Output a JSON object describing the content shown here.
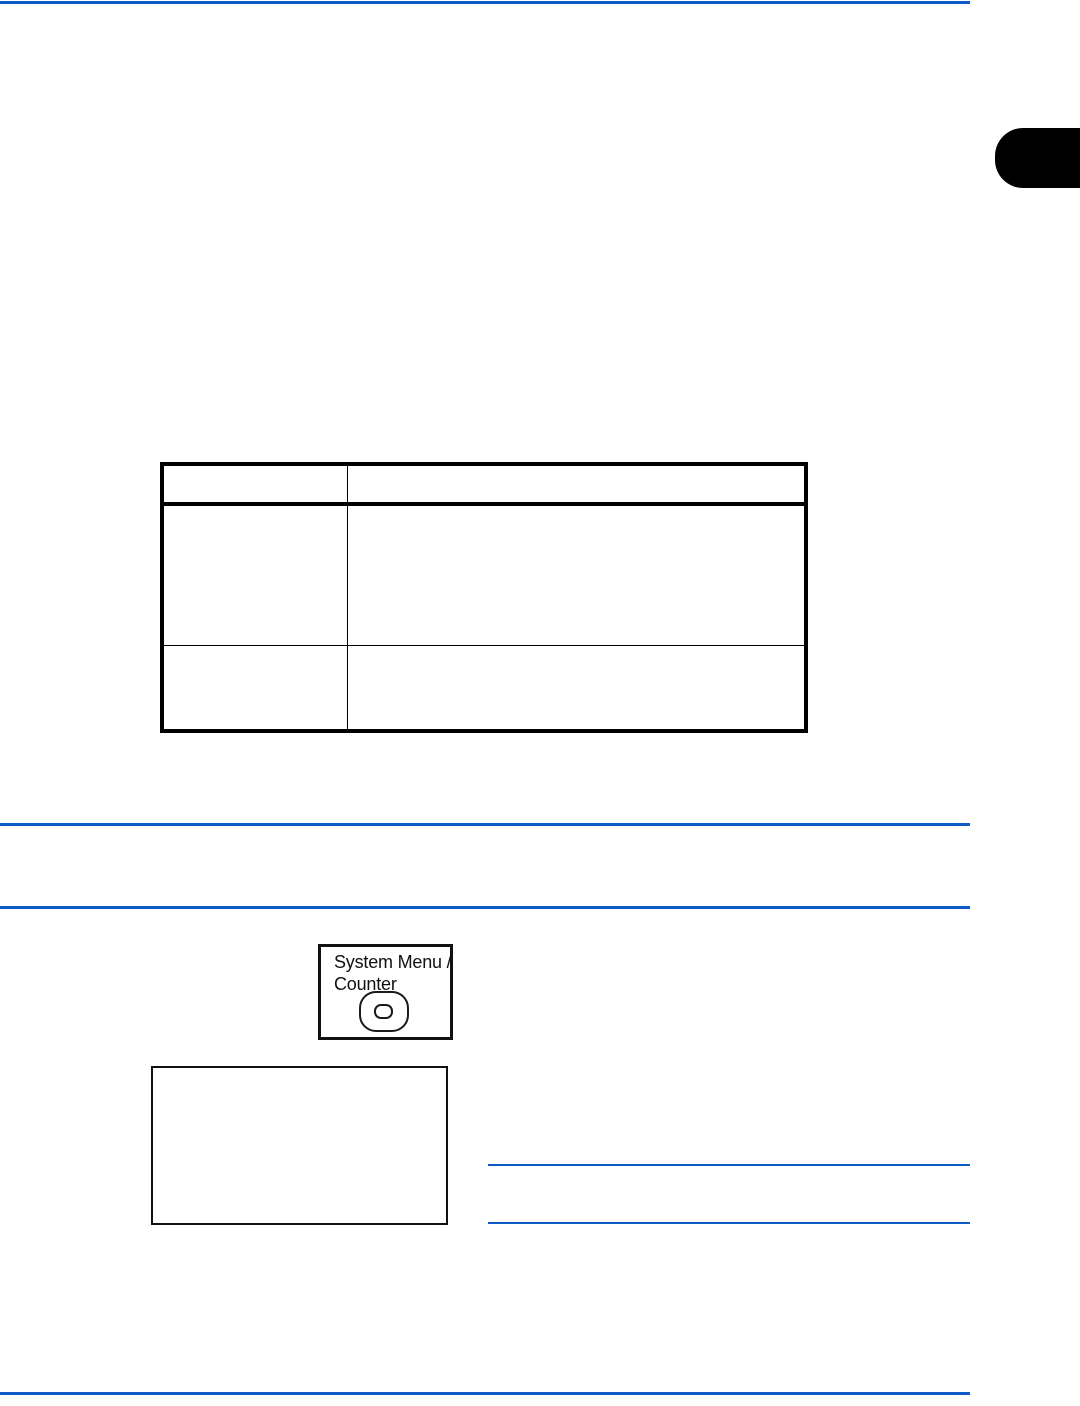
{
  "colors": {
    "rule_blue": "#0d5cc6",
    "ink_black": "#000000",
    "page_background": "#ffffff"
  },
  "edge_tab": {
    "icon": "chapter-index-tab"
  },
  "table": {
    "header_cells": [
      "",
      ""
    ],
    "rows": [
      [
        "",
        ""
      ],
      [
        "",
        ""
      ]
    ]
  },
  "key_illustration": {
    "label_line1": "System Menu /",
    "label_line2": "Counter",
    "icon": "oval-key-icon"
  },
  "screen_placeholder": {
    "content": ""
  }
}
